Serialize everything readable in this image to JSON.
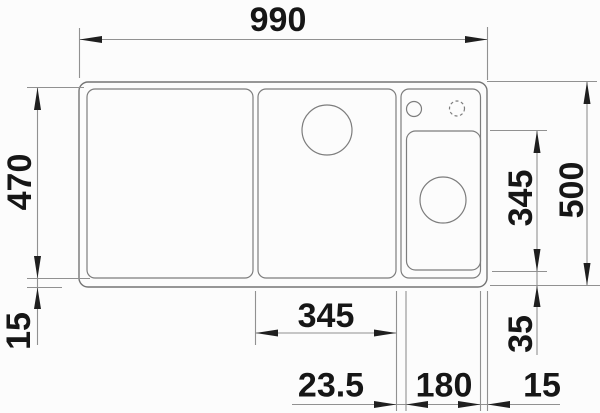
{
  "drawing": {
    "kind": "sink-top-view-dimension-drawing",
    "colors": {
      "background": "#fcfcfc",
      "outline": "#757575",
      "dimension_lines": "#919191",
      "text": "#161616"
    },
    "dimensions": {
      "overall_width": "990",
      "main_bowl_depth": "470",
      "front_rim_left": "15",
      "overall_depth": "500",
      "right_bowl_length": "345",
      "right_bowl_front_offset": "35",
      "main_bowl_width": "345",
      "divider_width": "23.5",
      "right_bowl_width": "180",
      "right_rim_width": "15"
    }
  }
}
